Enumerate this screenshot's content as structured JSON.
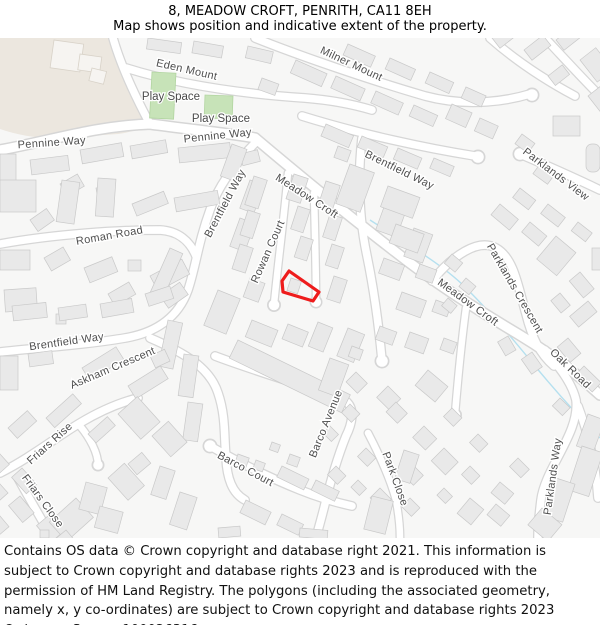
{
  "header": {
    "title": "8, MEADOW CROFT, PENRITH, CA11 8EH",
    "subtitle": "Map shows position and indicative extent of the property."
  },
  "map": {
    "street_labels": [
      {
        "text": "Eden Mount"
      },
      {
        "text": "Pennine Way"
      },
      {
        "text": "Pennine Way"
      },
      {
        "text": "Milner Mount"
      },
      {
        "text": "Brentfield Way"
      },
      {
        "text": "Parklands View"
      },
      {
        "text": "Meadow Croft"
      },
      {
        "text": "Brentfield Way"
      },
      {
        "text": "Roman Road"
      },
      {
        "text": "Rowan Court"
      },
      {
        "text": "Meadow Croft"
      },
      {
        "text": "Parklands Crescent"
      },
      {
        "text": "Oak Road"
      },
      {
        "text": "Brentfield Way"
      },
      {
        "text": "Askham Crescent"
      },
      {
        "text": "Friars Rise"
      },
      {
        "text": "Friars Close"
      },
      {
        "text": "Barco Court"
      },
      {
        "text": "Barco Avenue"
      },
      {
        "text": "Park Close"
      },
      {
        "text": "Parklands Way"
      }
    ],
    "area_labels": [
      {
        "text": "Play Space"
      },
      {
        "text": "Play Space"
      }
    ],
    "property": {
      "outline_color": "#ee1c1c"
    },
    "colors": {
      "background": "#f7f7f6",
      "land_tint": "#ece7df",
      "building": "#e9e9e9",
      "building_border": "#c9c9c9",
      "road_fill": "#ffffff",
      "road_casing": "#d6d6d6",
      "green_space": "#c7e3b8",
      "water": "#b5e0ef",
      "label_text": "#4e4e4e"
    }
  },
  "footer": {
    "text": "Contains OS data © Crown copyright and database right 2021. This information is subject to Crown copyright and database rights 2023 and is reproduced with the permission of HM Land Registry. The polygons (including the associated geometry, namely x, y co-ordinates) are subject to Crown copyright and database rights 2023 Ordnance Survey 100026316."
  }
}
